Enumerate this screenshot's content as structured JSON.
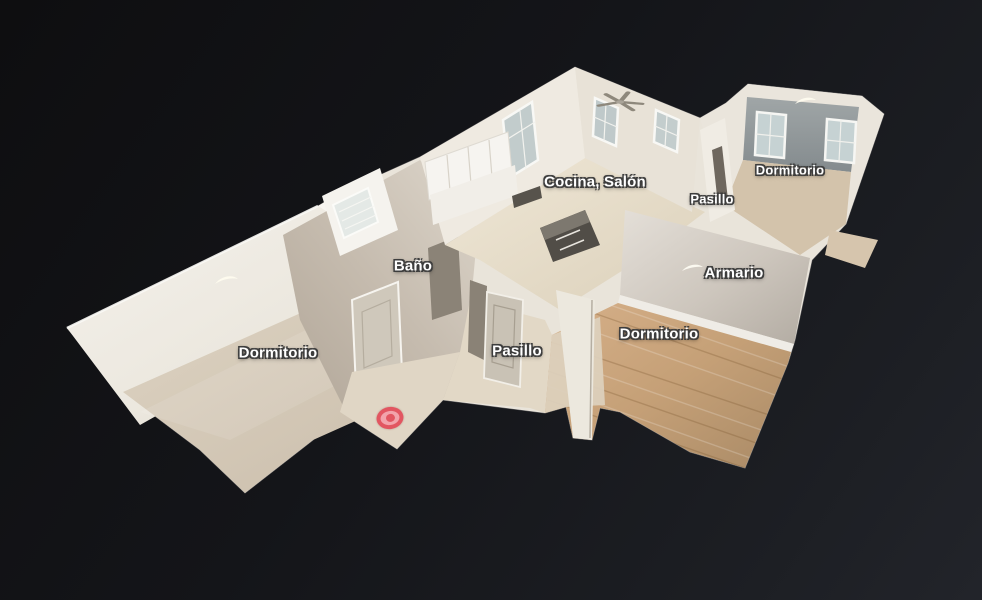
{
  "viewer": {
    "background_color": "#121317",
    "label_text_color": "#ffffff",
    "label_outline_color": "#3d3d3d",
    "room_labels": [
      {
        "id": "cocina-salon",
        "label": "Cocina, Salón"
      },
      {
        "id": "dormitorio-top-right",
        "label": "Dormitorio"
      },
      {
        "id": "pasillo-top",
        "label": "Pasillo"
      },
      {
        "id": "bano",
        "label": "Baño"
      },
      {
        "id": "armario",
        "label": "Armario"
      },
      {
        "id": "dormitorio-right",
        "label": "Dormitorio"
      },
      {
        "id": "pasillo-center",
        "label": "Pasillo"
      },
      {
        "id": "dormitorio-left",
        "label": "Dormitorio"
      }
    ],
    "scan_marker": {
      "shape": "bullseye",
      "ring_color": "#e25661",
      "fill_color": "#f2a3ab"
    }
  }
}
